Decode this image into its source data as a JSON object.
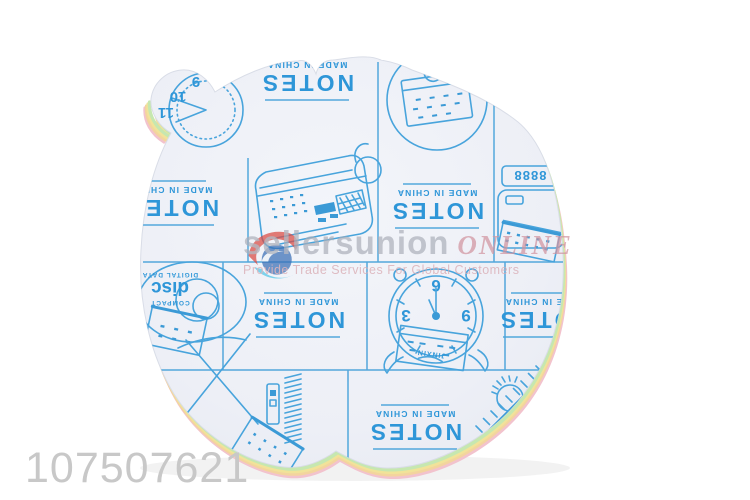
{
  "product": {
    "code": "107507621"
  },
  "watermark": {
    "brand": "sellersunion",
    "brand_suffix": "ONLINE",
    "tagline": "Provide Trade Services For Global Customers"
  },
  "pad": {
    "shape": "apple-shaped sticky note pad",
    "notes_label": "NOTES",
    "origin_label": "MADE IN CHINA",
    "doodles": {
      "clock": {
        "numbers": [
          "3",
          "6",
          "9"
        ],
        "calendar_brand": "JINXIN"
      },
      "corner_clock": {
        "numbers": [
          "9",
          "10",
          "11"
        ]
      },
      "register": {
        "display": "8888"
      },
      "disc": {
        "top_label": "COMPACT",
        "label": "disc",
        "bottom_label": "DIGITAL DATA"
      }
    },
    "colors": {
      "print_blue": "#3b9ad6",
      "paper": "#eef0f6",
      "sheet_green": "#c6e7b0",
      "sheet_yellow": "#f1e399",
      "sheet_orange": "#f3d49e",
      "sheet_pink": "#f2c3cd",
      "watermark_gray": "#a9adb8",
      "watermark_pink": "#d295a0",
      "code_gray": "#c8c8c8"
    }
  }
}
